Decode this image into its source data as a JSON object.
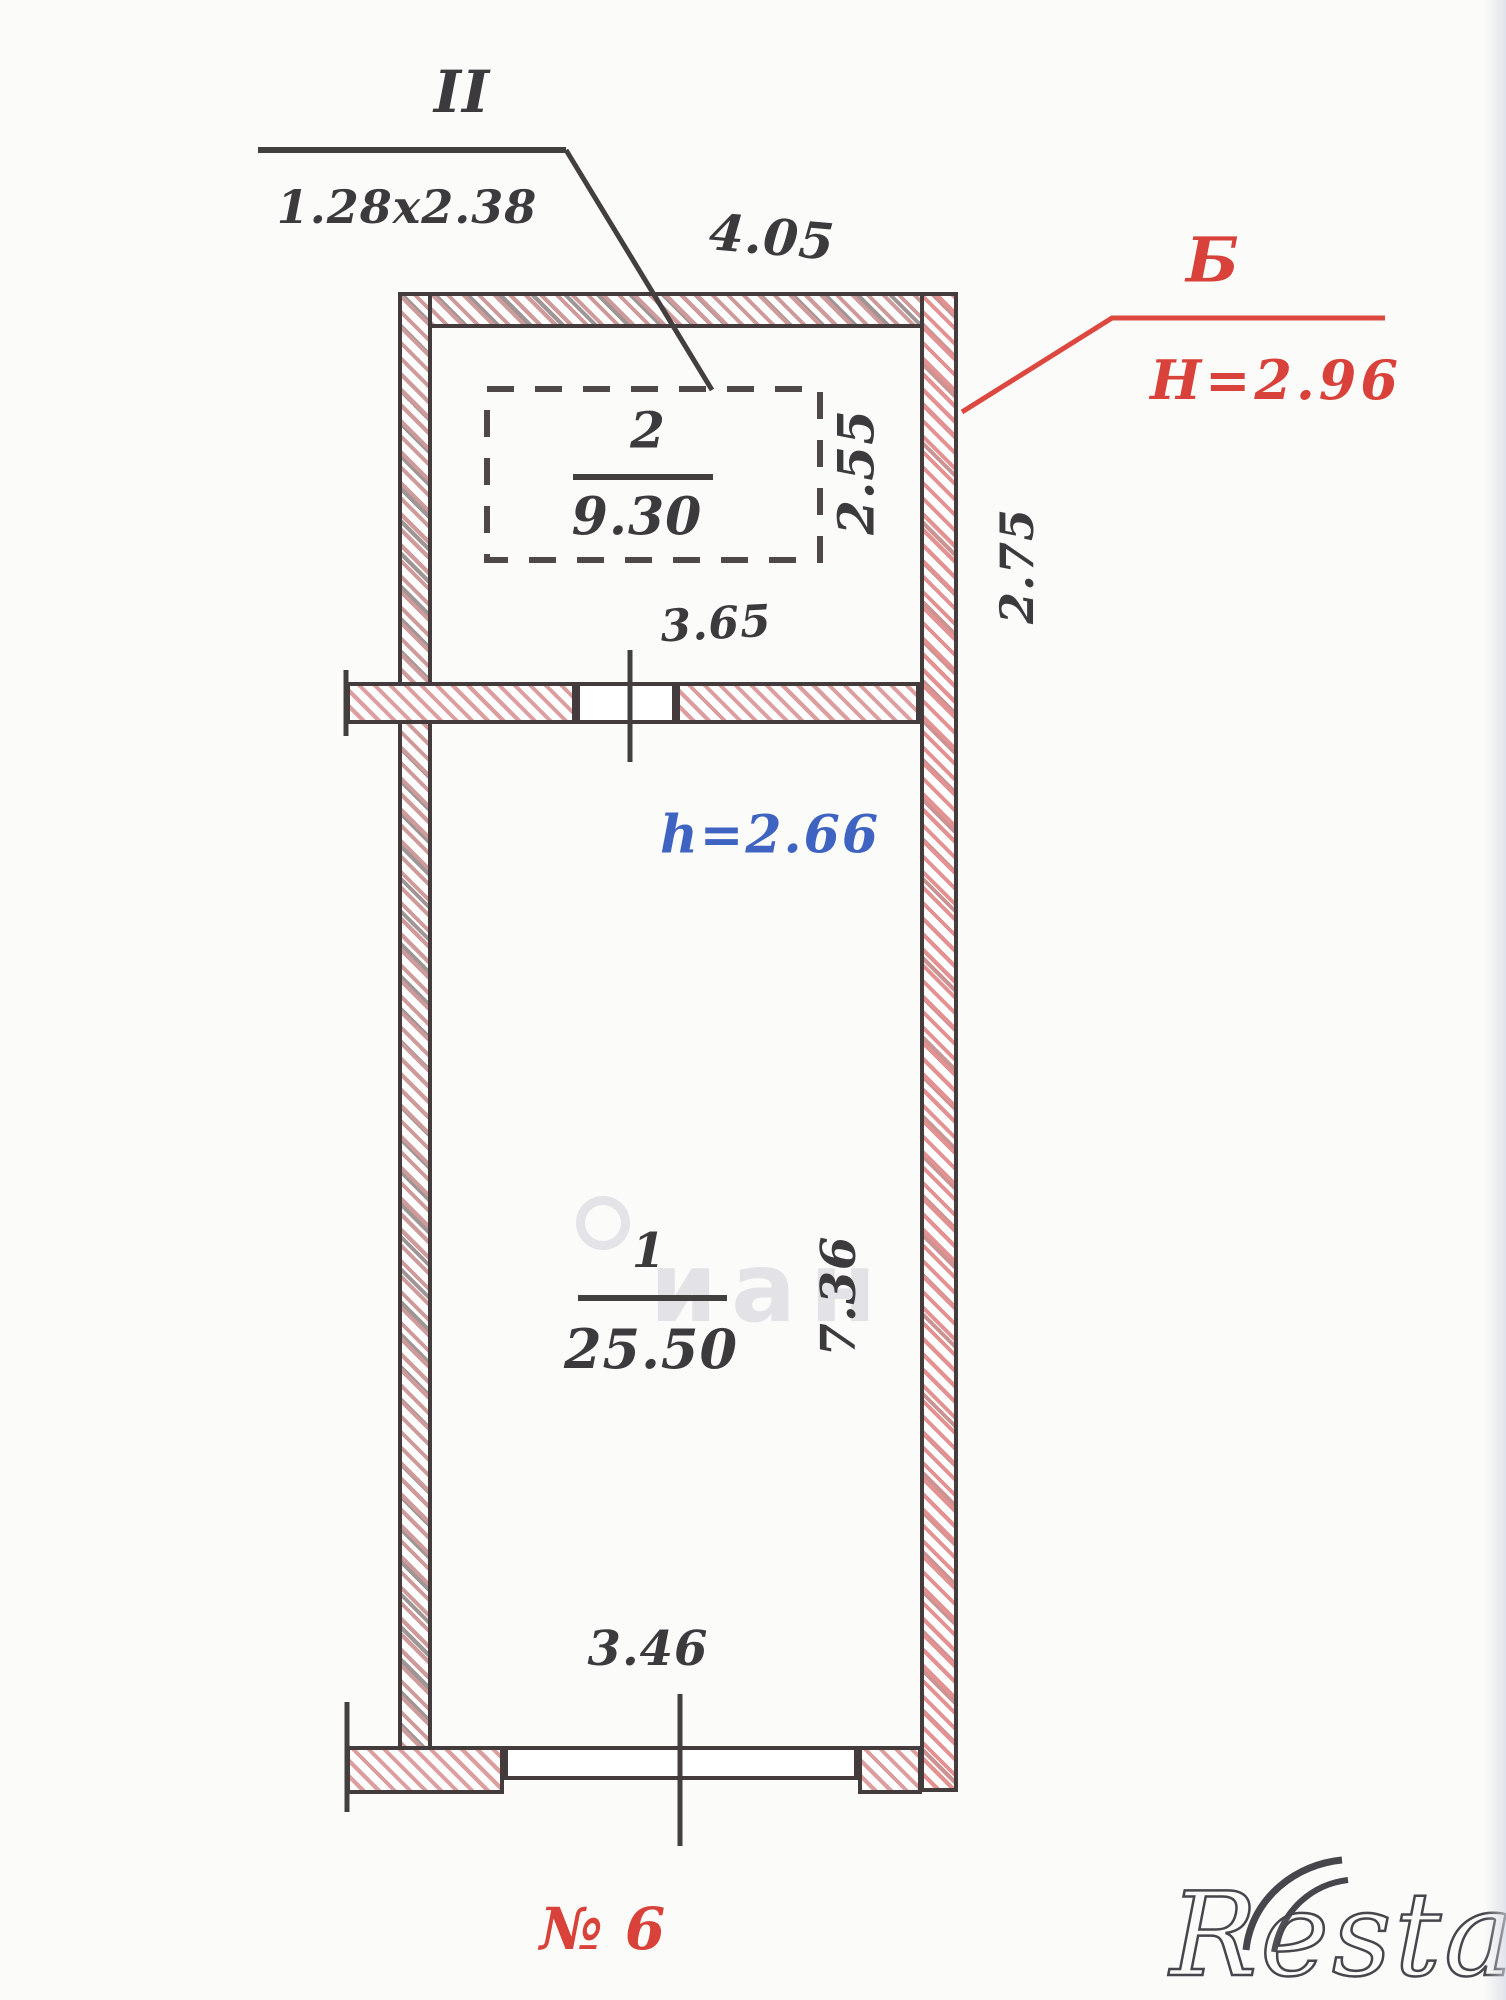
{
  "plan": {
    "window_mark": {
      "label": "II",
      "dimensions": "1.28x2.38"
    },
    "dimensions": {
      "top_width": "4.05",
      "room2_width": "3.65",
      "room2_depth": "2.55",
      "side_depth": "2.75",
      "room1_width": "3.46",
      "room1_depth": "7.36"
    },
    "section_mark": {
      "letter": "Б",
      "floor_height": "H=2.96"
    },
    "ceiling_height": "h=2.66",
    "rooms": [
      {
        "number": "1",
        "area": "25.50"
      },
      {
        "number": "2",
        "area": "9.30"
      }
    ],
    "unit_number": "№ 6"
  },
  "watermarks": {
    "restate": "Restate",
    "cian": "иан"
  },
  "colors": {
    "ink": "#3d3a3e",
    "red": "#d8423a",
    "blue": "#3f63c0",
    "hatch_pink": "#dc9e9e",
    "paper": "#fbfbfa"
  }
}
